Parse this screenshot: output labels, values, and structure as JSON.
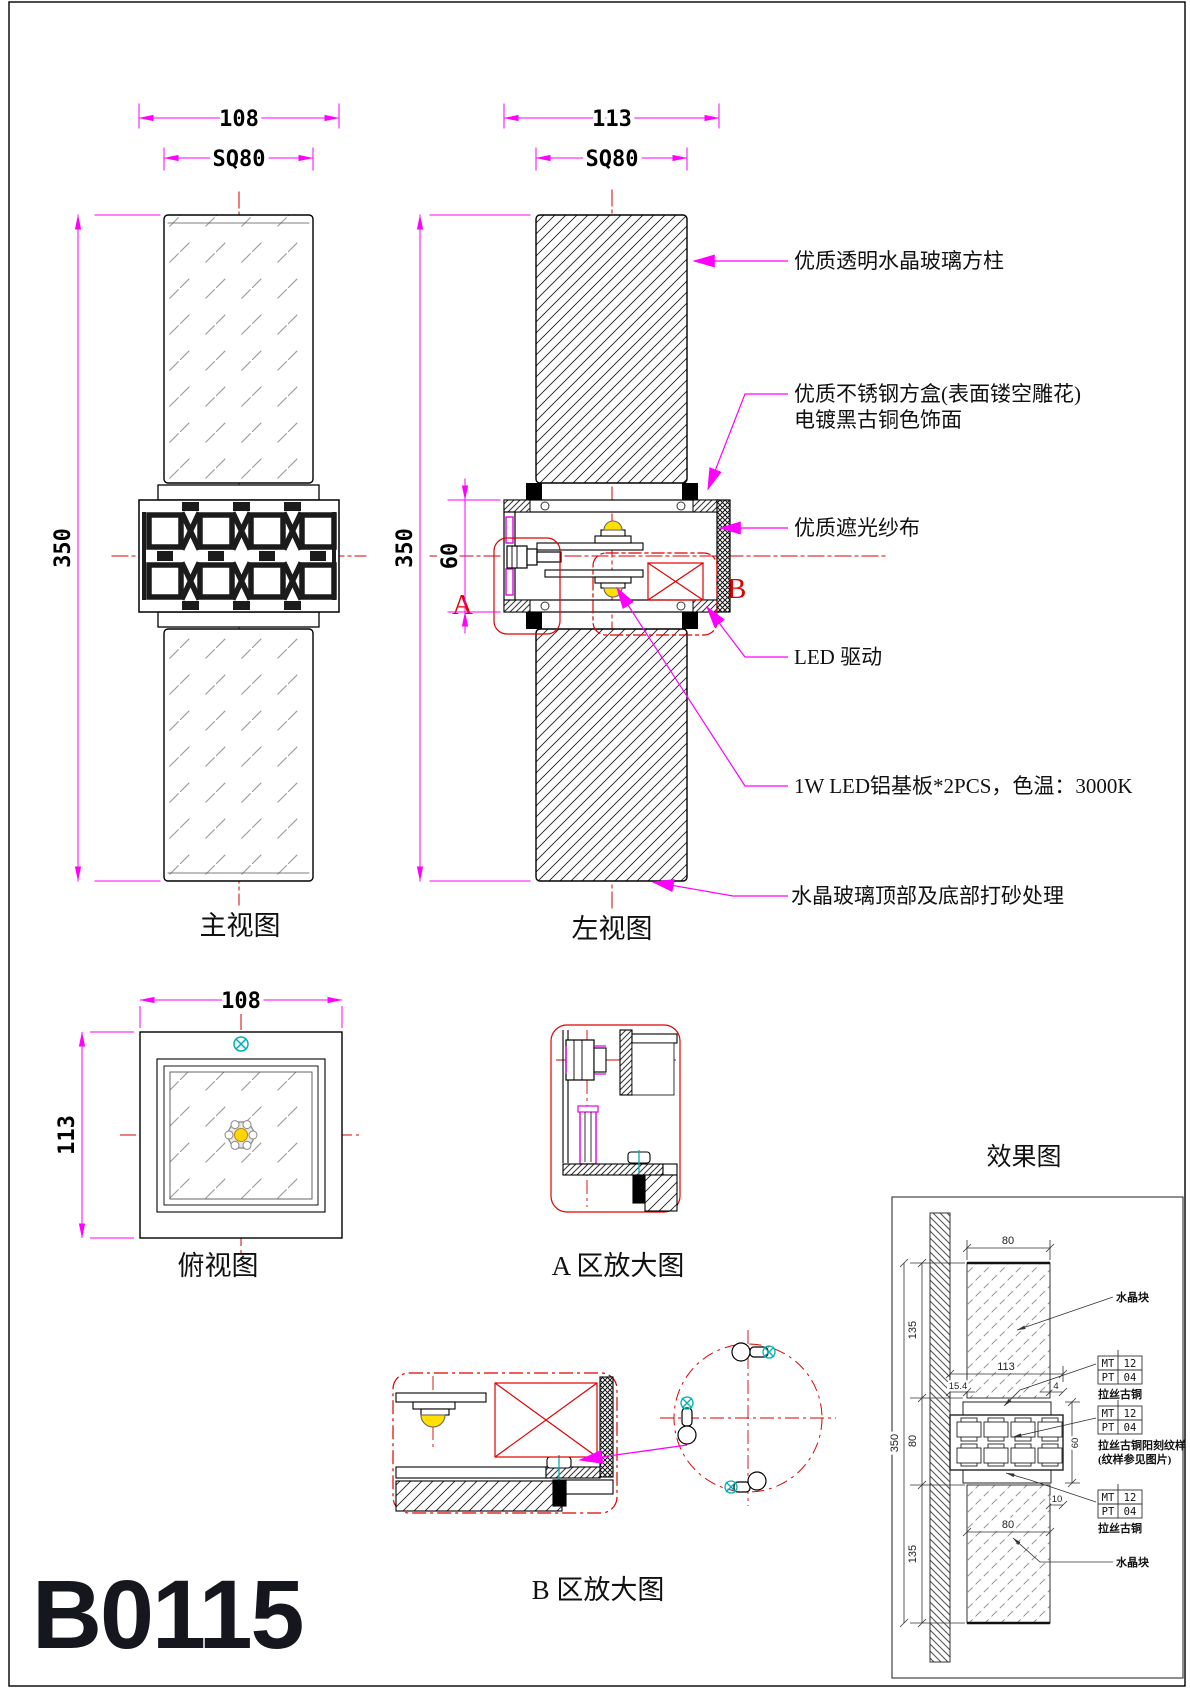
{
  "sheet": {
    "code": "B0115"
  },
  "views": {
    "front": {
      "label": "主视图",
      "dim_width": "108",
      "dim_square": "SQ80",
      "dim_height": "350"
    },
    "left": {
      "label": "左视图",
      "dim_width": "113",
      "dim_square": "SQ80",
      "dim_height": "350",
      "dim_box_height": "60",
      "zone_a": "A",
      "zone_b": "B"
    },
    "top": {
      "label": "俯视图",
      "dim_width": "108",
      "dim_depth": "113"
    },
    "detail_a": {
      "label": "A 区放大图"
    },
    "detail_b": {
      "label": "B 区放大图"
    }
  },
  "annotations": {
    "glass_column": "优质透明水晶玻璃方柱",
    "steel_box_1": "优质不锈钢方盒(表面镂空雕花)",
    "steel_box_2": "电镀黑古铜色饰面",
    "gauze": "优质遮光纱布",
    "led_driver": "LED 驱动",
    "led_board": "1W LED铝基板*2PCS，色温：3000K",
    "sandblast": "水晶玻璃顶部及底部打砂处理"
  },
  "effect": {
    "title": "效果图",
    "dims": {
      "top_width": "80",
      "upper_height": "135",
      "depth": "113",
      "offset_left": "15.4",
      "offset_right": "4",
      "total_height": "350",
      "zone_height": "80",
      "box_height": "60",
      "lower_width": "80",
      "lower_offset": "10",
      "lower_height": "135"
    },
    "tables": [
      {
        "r1c1": "MT",
        "r1c2": "12",
        "r2c1": "PT",
        "r2c2": "04",
        "label1": "拉丝古铜",
        "label2": ""
      },
      {
        "r1c1": "MT",
        "r1c2": "12",
        "r2c1": "PT",
        "r2c2": "04",
        "label1": "拉丝古铜阳刻纹样",
        "label2": "(纹样参见图片)"
      },
      {
        "r1c1": "MT",
        "r1c2": "12",
        "r2c1": "PT",
        "r2c2": "04",
        "label1": "拉丝古铜",
        "label2": ""
      }
    ],
    "note_top": "水晶块",
    "note_bottom": "水晶块"
  }
}
